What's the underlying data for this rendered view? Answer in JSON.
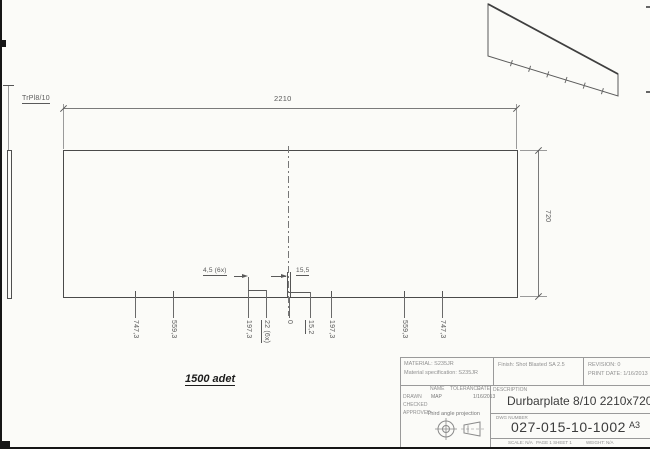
{
  "colors": {
    "paper": "#fbfbf8",
    "line": "#4f4f4f",
    "faint_line": "#9a9a9a",
    "dim_text": "#5a5a5a",
    "title_text": "#3c3c3c"
  },
  "drawing": {
    "side_view_label": "TrPl8/10",
    "quantity_note": "1500 adet",
    "dims": {
      "overall_width": "2210",
      "overall_height": "720",
      "hole_dia": "4,5 (6x)",
      "slot_width": "15,5",
      "ordinates": [
        "747,3",
        "559,3",
        "197,3",
        "22 (6x)",
        "0",
        "15,2",
        "197,3",
        "559,3",
        "747,3"
      ]
    }
  },
  "title_block": {
    "material_label": "MATERIAL: S235JR",
    "material_spec": "Material specification: S235JR",
    "finish": "Finish: Shot Blasted SA 2.5",
    "revision": "REVISION: 0",
    "print_date": "PRINT DATE: 1/16/2013",
    "col_name": "NAME",
    "col_tolerance": "TOLERANCE",
    "col_date": "DATE",
    "row_drawn": "DRAWN",
    "drawn_name": "MAP",
    "drawn_date": "1/16/2013",
    "row_checked": "CHECKED",
    "row_approved": "APPROVED",
    "projection_note": "Third angle projection",
    "description_label": "DESCRIPTION",
    "description": "Durbarplate 8/10 2210x720",
    "dwg_label": "DWG NUMBER",
    "dwg_number": "027-015-10-1002",
    "sheet_size": "A3",
    "scale": "SCALE: N/A",
    "page": "PAGE 1 SHEET 1",
    "weight": "WEIGHT: N/A"
  }
}
